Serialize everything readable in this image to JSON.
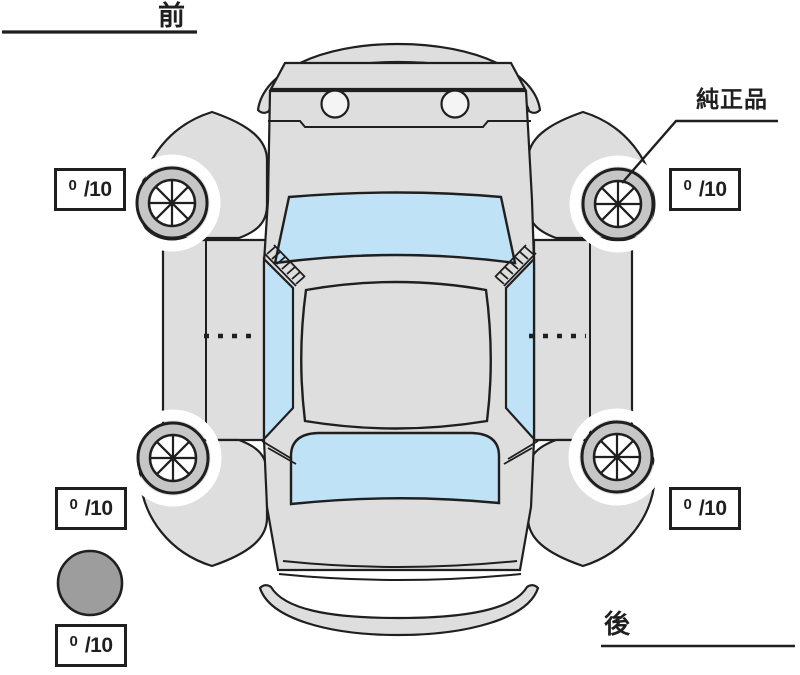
{
  "labels": {
    "front": "前",
    "rear": "後",
    "genuine_part": "純正品"
  },
  "tread_ratings": {
    "front_left": {
      "value": "0",
      "suffix": "/10"
    },
    "front_right": {
      "value": "0",
      "suffix": "/10"
    },
    "rear_left": {
      "value": "0",
      "suffix": "/10"
    },
    "rear_right": {
      "value": "0",
      "suffix": "/10"
    },
    "spare": {
      "value": "0",
      "suffix": "/10"
    }
  },
  "icons": {
    "wheel": "wheel-with-eight-spokes",
    "spare_tire": "filled-gray-circle"
  },
  "colors": {
    "body": "#dedede",
    "glass": "#bfe2f6",
    "ring": "#c6c6c6",
    "spare": "#9d9d9d",
    "outline": "#1f1f1f",
    "paper": "#ffffff"
  }
}
